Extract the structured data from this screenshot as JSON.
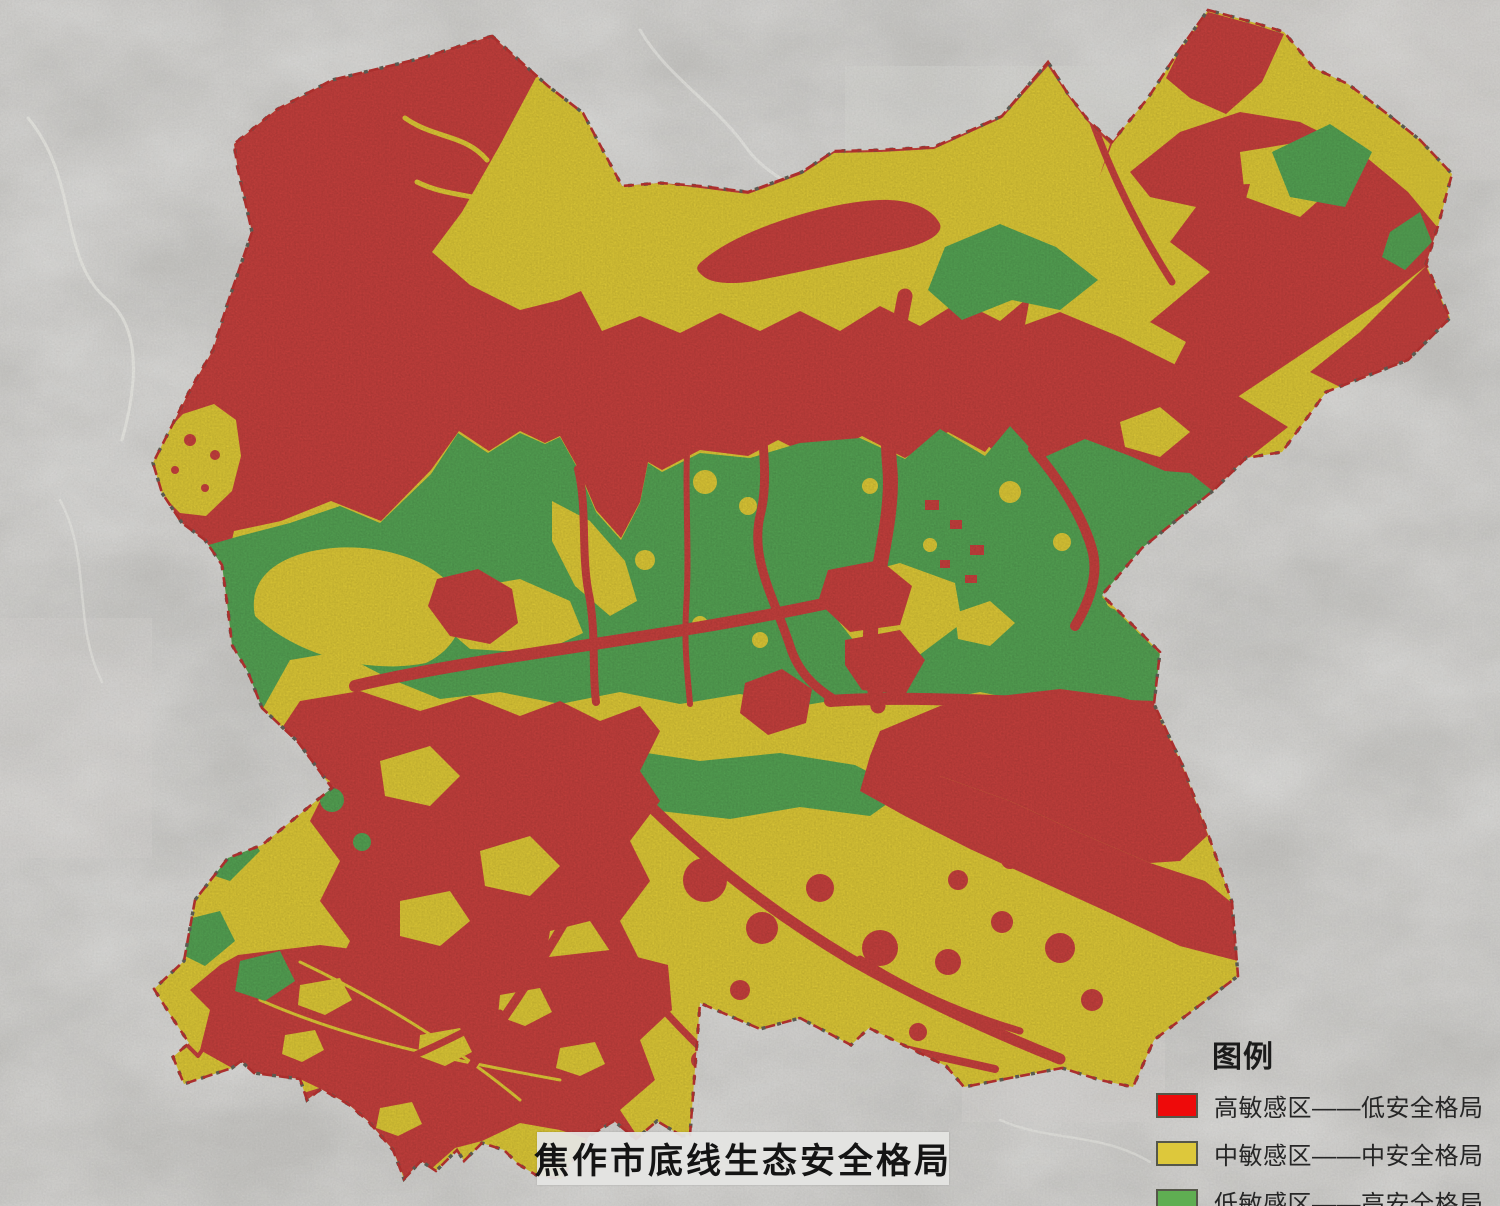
{
  "page": {
    "background_color": "#c8c7c4"
  },
  "map": {
    "title": "焦作市底线生态安全格局",
    "legend": {
      "heading": "图例",
      "items": [
        {
          "id": "high-sensitivity-low-security",
          "label": "高敏感区——低安全格局",
          "color": "#ee0a0a"
        },
        {
          "id": "medium-sensitivity-medium-security",
          "label": "中敏感区——中安全格局",
          "color": "#ddc83b"
        },
        {
          "id": "low-sensitivity-high-security",
          "label": "低敏感区——高安全格局",
          "color": "#5fae52"
        }
      ]
    },
    "region_colors": {
      "high": "#ce4340",
      "medium": "#e7d139",
      "low": "#58a957"
    },
    "boundary_color": "#b53230"
  }
}
